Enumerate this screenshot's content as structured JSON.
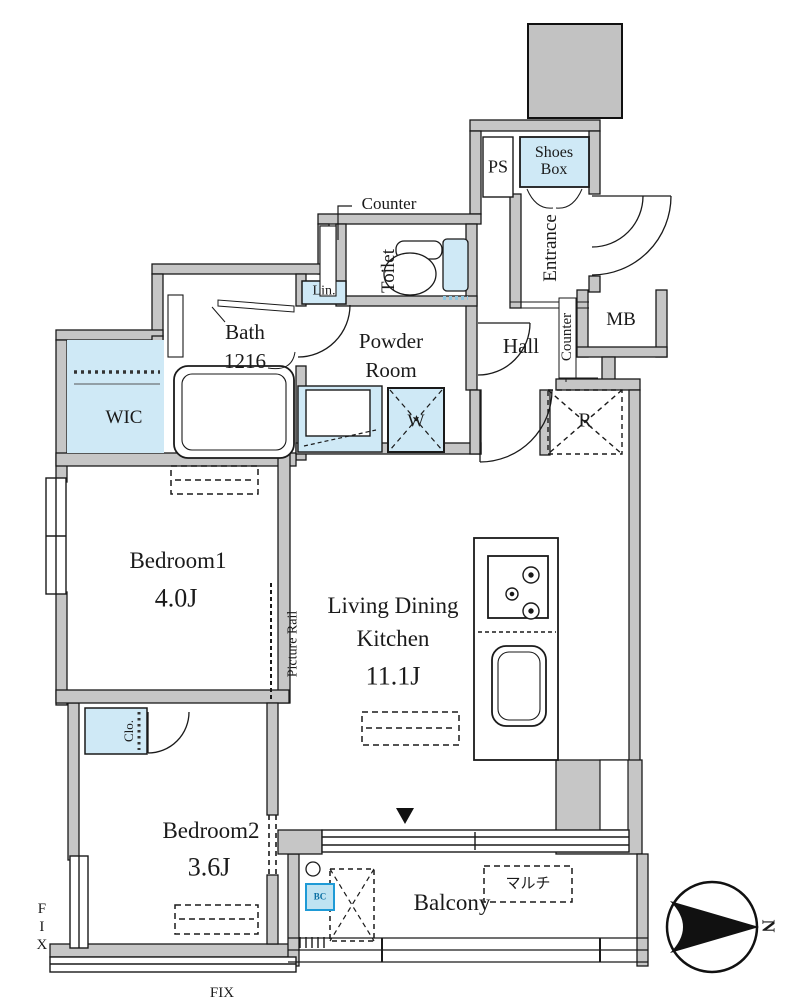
{
  "plan_title": "apartment floor plan",
  "rooms": {
    "bedroom1": {
      "name": "Bedroom1",
      "size": "4.0J"
    },
    "bedroom2": {
      "name": "Bedroom2",
      "size": "3.6J"
    },
    "ldk": {
      "line1": "Living Dining",
      "line2": "Kitchen",
      "size": "11.1J"
    },
    "bath": {
      "name": "Bath",
      "size": "1216"
    },
    "powder": {
      "line1": "Powder",
      "line2": "Room"
    },
    "toilet": {
      "name": "Toilet"
    },
    "hall": {
      "name": "Hall"
    },
    "entrance": {
      "name": "Entrance"
    },
    "balcony": {
      "name": "Balcony"
    },
    "wic": {
      "name": "WIC"
    }
  },
  "labels": {
    "ps": "PS",
    "shoes_box": "Shoes Box",
    "mb": "MB",
    "lin": "Lin.",
    "clo": "Clo.",
    "washer": "W",
    "fridge": "R",
    "counter_top": "Counter",
    "counter_side": "Counter",
    "picture_rail": "Picture Rail",
    "multi": "マルチ",
    "bc": "BC",
    "fix_left": "FIX",
    "fix_bottom": "FIX",
    "north": "N"
  },
  "colors": {
    "wall": "#c6c6c6",
    "closet_fill": "#cfe9f6",
    "accent_blue": "#2b9fd3",
    "line": "#1a1a1a"
  }
}
